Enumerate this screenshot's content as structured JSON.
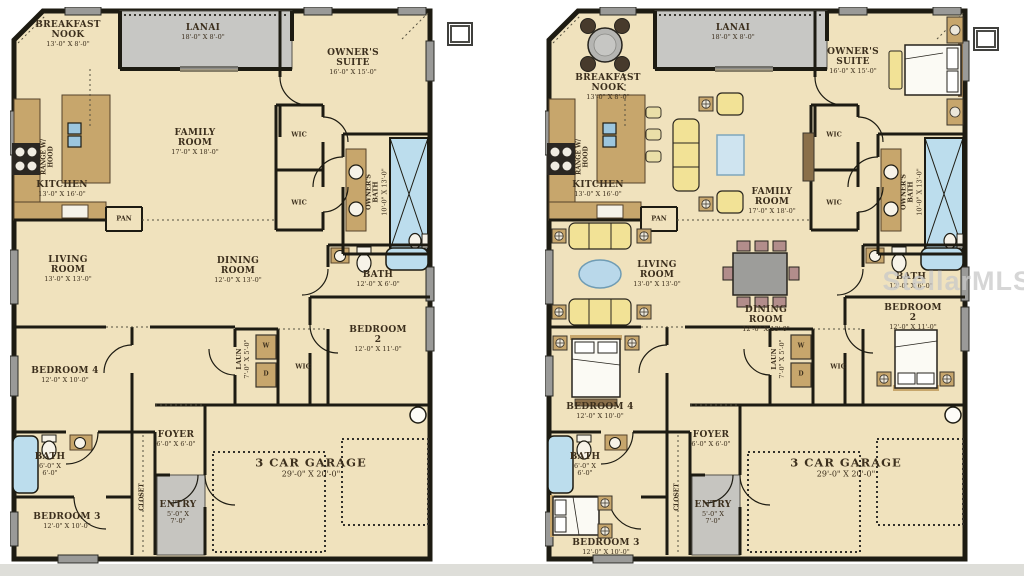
{
  "watermark": "StellarMLS",
  "colors": {
    "wall": "#1d1b12",
    "room_fill": "#f0e2bd",
    "porch_gray": "#c7c7c4",
    "water_blue": "#aacfe4",
    "cabinet_brown": "#c7a66c",
    "sofa_yellow": "#f2e296",
    "chair_pink": "#b28d8b",
    "watermark_gray": "#c9c9c9"
  },
  "plans": [
    {
      "id": "floorplan-unfurnished",
      "rooms": {
        "breakfast_nook": {
          "label": "BREAKFAST\nNOOK",
          "dims": "13'-0\" X 8'-0\""
        },
        "lanai": {
          "label": "LANAI",
          "dims": "18'-0\" X 8'-0\""
        },
        "owners_suite": {
          "label": "OWNER'S\nSUITE",
          "dims": "16'-0\" X 15'-0\""
        },
        "family_room": {
          "label": "FAMILY\nROOM",
          "dims": "17'-0\" X 18'-0\""
        },
        "kitchen": {
          "label": "KITCHEN",
          "dims": "13'-0\" X 16'-0\""
        },
        "range_hood": {
          "label": "RANGE W/\nHOOD"
        },
        "pantry": {
          "label": "PAN"
        },
        "owners_bath": {
          "label": "OWNER'S\nBATH",
          "dims": "10'-0\" X 13'-0\""
        },
        "wic_upper": {
          "label": "WIC"
        },
        "wic_lower": {
          "label": "WIC"
        },
        "living_room": {
          "label": "LIVING\nROOM",
          "dims": "13'-0\" X 13'-0\""
        },
        "dining_room": {
          "label": "DINING\nROOM",
          "dims": "12'-0\" X 13'-0\""
        },
        "bath_hall": {
          "label": "BATH",
          "dims": "12'-0\" X 6'-0\""
        },
        "bedroom_2": {
          "label": "BEDROOM 2",
          "dims": "12'-0\" X 11'-0\""
        },
        "wic_bedroom2": {
          "label": "WIC"
        },
        "laundry": {
          "label": "LAUN",
          "dims": "7'-0\" X 5'-0\"",
          "washer": "W",
          "dryer": "D"
        },
        "bedroom_4": {
          "label": "BEDROOM 4",
          "dims": "12'-0\" X 10'-0\""
        },
        "bath_secondary": {
          "label": "BATH",
          "dims": "6'-0\" X\n6'-0\""
        },
        "bedroom_3": {
          "label": "BEDROOM 3",
          "dims": "12'-0\" X 10'-0\""
        },
        "closet": {
          "label": "CLOSET"
        },
        "foyer": {
          "label": "FOYER",
          "dims": "6'-0\" X 6'-0\""
        },
        "entry": {
          "label": "ENTRY",
          "dims": "5'-0\" X\n7'-0\""
        },
        "garage": {
          "label": "3 CAR GARAGE",
          "dims": "29'-0\" X 20'-0\""
        }
      }
    },
    {
      "id": "floorplan-furnished",
      "rooms": {
        "breakfast_nook": {
          "label": "BREAKFAST\nNOOK",
          "dims": "13'-0\" X 8'-0\""
        },
        "lanai": {
          "label": "LANAI",
          "dims": "18'-0\" X 8'-0\""
        },
        "owners_suite": {
          "label": "OWNER'S\nSUITE",
          "dims": "16'-0\" X 15'-0\""
        },
        "family_room": {
          "label": "FAMILY\nROOM",
          "dims": "17'-0\" X 18'-0\""
        },
        "kitchen": {
          "label": "KITCHEN",
          "dims": "13'-0\" X 16'-0\""
        },
        "range_hood": {
          "label": "RANGE W/\nHOOD"
        },
        "pantry": {
          "label": "PAN"
        },
        "owners_bath": {
          "label": "OWNER'S\nBATH",
          "dims": "10'-0\" X 13'-0\""
        },
        "wic_upper": {
          "label": "WIC"
        },
        "wic_lower": {
          "label": "WIC"
        },
        "living_room": {
          "label": "LIVING\nROOM",
          "dims": "13'-0\" X 13'-0\""
        },
        "dining_room": {
          "label": "DINING\nROOM",
          "dims": "12'-0\" X 13'-0\""
        },
        "bath_hall": {
          "label": "BATH",
          "dims": "12'-0\" X 6'-0\""
        },
        "bedroom_2": {
          "label": "BEDROOM 2",
          "dims": "12'-0\" X 11'-0\""
        },
        "wic_bedroom2": {
          "label": "WIC"
        },
        "laundry": {
          "label": "LAUN",
          "dims": "7'-0\" X 5'-0\"",
          "washer": "W",
          "dryer": "D"
        },
        "bedroom_4": {
          "label": "BEDROOM 4",
          "dims": "12'-0\" X 10'-0\""
        },
        "bath_secondary": {
          "label": "BATH",
          "dims": "6'-0\" X\n6'-0\""
        },
        "bedroom_3": {
          "label": "BEDROOM 3",
          "dims": "12'-0\" X 10'-0\""
        },
        "closet": {
          "label": "CLOSET"
        },
        "foyer": {
          "label": "FOYER",
          "dims": "6'-0\" X 6'-0\""
        },
        "entry": {
          "label": "ENTRY",
          "dims": "5'-0\" X\n7'-0\""
        },
        "garage": {
          "label": "3 CAR GARAGE",
          "dims": "29'-0\" X 20'-0\""
        }
      }
    }
  ]
}
